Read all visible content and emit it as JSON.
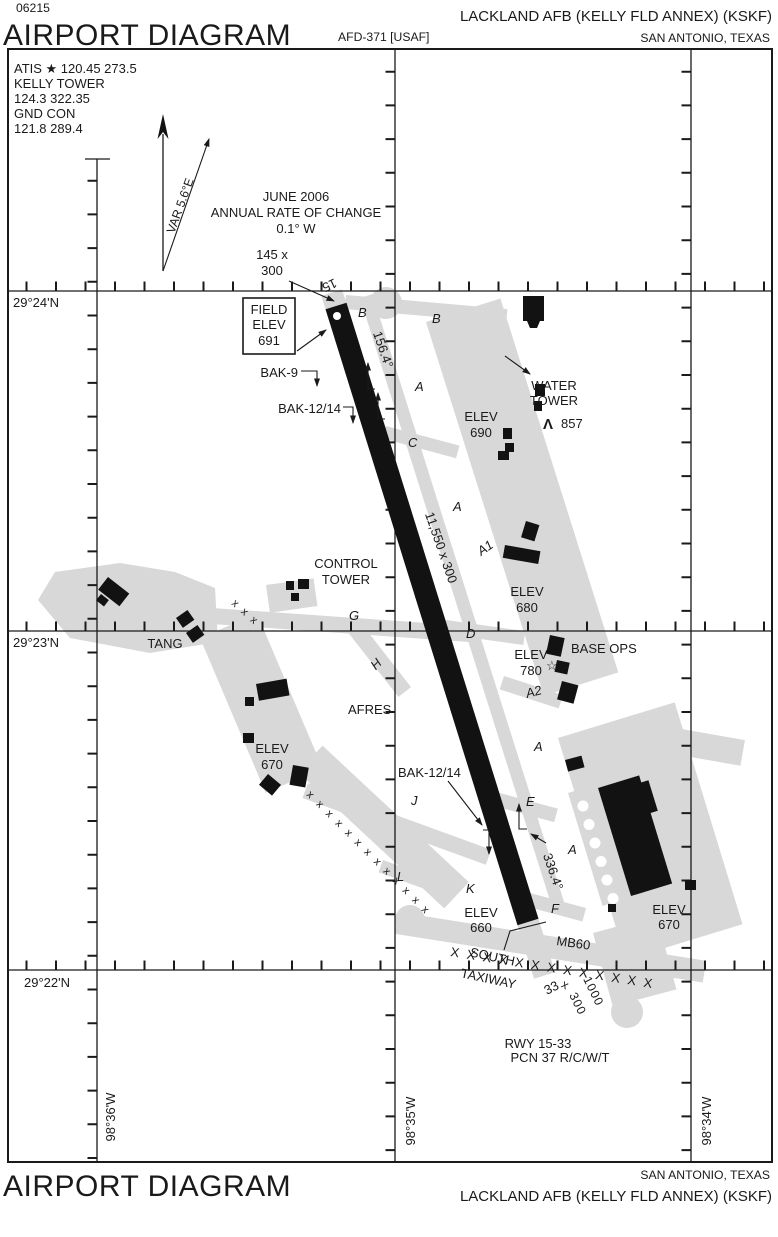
{
  "header": {
    "chart_number": "06215",
    "title": "AIRPORT DIAGRAM",
    "afd_ref": "AFD-371 [USAF]",
    "airport": "LACKLAND AFB (KELLY FLD ANNEX)  (KSKF)",
    "city": "SAN ANTONIO, TEXAS"
  },
  "footer": {
    "title": "AIRPORT DIAGRAM",
    "airport": "LACKLAND AFB (KELLY FLD ANNEX)  (KSKF)",
    "city": "SAN ANTONIO, TEXAS"
  },
  "comms": {
    "line1": "ATIS ★ 120.45  273.5",
    "line2": "KELLY TOWER",
    "line3": "124.3  322.35",
    "line4": "GND CON",
    "line5": "121.8  289.4"
  },
  "compass": {
    "variation": "VAR 5.6°E",
    "date": "JUNE 2006",
    "rate_label": "ANNUAL RATE OF CHANGE",
    "rate_value": "0.1° W"
  },
  "grid": {
    "lat_29_24": "29°24'N",
    "lat_29_23": "29°23'N",
    "lat_29_22": "29°22'N",
    "lon_98_36": "98°36'W",
    "lon_98_35": "98°35'W",
    "lon_98_34": "98°34'W"
  },
  "field": {
    "line1": "FIELD",
    "line2": "ELEV",
    "value": "691"
  },
  "runway": {
    "rw15": "15",
    "rw33": "33",
    "size": "11,550 x 300",
    "hdg_se": "156.4°",
    "hdg_nw": "336.4°",
    "overrun_n_line1": "145 x",
    "overrun_n_line2": "300",
    "overrun_s_len": "1000",
    "overrun_s_x": "x",
    "overrun_s_wid": "300",
    "info1": "RWY 15-33",
    "info2": "PCN 37 R/C/W/T"
  },
  "barriers": {
    "bak9": "BAK-9",
    "bak1214_n": "BAK-12/14",
    "bak1214_s": "BAK-12/14",
    "mb60": "MB60"
  },
  "taxiways": {
    "b_w": "B",
    "b_e": "B",
    "a_n": "A",
    "c": "C",
    "a_mid": "A",
    "a1": "A1",
    "d": "D",
    "g": "G",
    "h": "H",
    "a2": "A2",
    "j": "J",
    "e": "E",
    "a_s1": "A",
    "l": "L",
    "k": "K",
    "a_s2": "A",
    "f": "F",
    "south_1": "SOUTH",
    "south_2": "TAXIWAY"
  },
  "facilities": {
    "water_tower_1": "WATER",
    "water_tower_2": "TOWER",
    "obstruction_symbol": "Λ",
    "obstruction_elev": "857",
    "control_tower_1": "CONTROL",
    "control_tower_2": "TOWER",
    "base_ops": "BASE OPS",
    "base_ops_star": "☆",
    "tang": "TANG",
    "afres": "AFRES"
  },
  "elevations": {
    "word": "ELEV",
    "e690": "690",
    "e680": "680",
    "e780": "780",
    "e670_w": "670",
    "e660": "660",
    "e670_e": "670"
  },
  "marks": {
    "closed_diag": "x x x x x x x x x x x x x",
    "closed_trio": "x x x",
    "closed_south": "X X X X X X X X X X X X X"
  }
}
